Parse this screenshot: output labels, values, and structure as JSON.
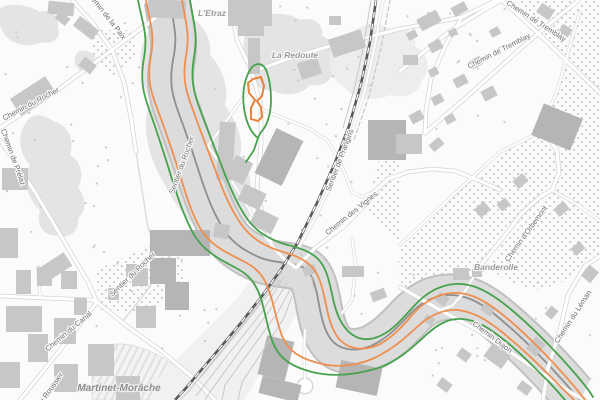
{
  "map": {
    "kind": "grayscale-street-map",
    "streets": [
      {
        "id": "chemin-de-la-paix",
        "text": "Chemin de la Paix"
      },
      {
        "id": "chemin-du-rocher",
        "text": "Chemin du Rocher"
      },
      {
        "id": "chemin-de-prelaz",
        "text": "Chemin de Prélaz"
      },
      {
        "id": "chemin-de-tremblay-1",
        "text": "Chemin de Tremblay"
      },
      {
        "id": "chemin-de-tremblay-2",
        "text": "Chemin de Tremblay"
      },
      {
        "id": "sentier-de-prangins",
        "text": "Sentier de Prangins"
      },
      {
        "id": "sentier-du-rocher-upper",
        "text": "Sentier du Rocher"
      },
      {
        "id": "chemin-des-vignes",
        "text": "Chemin des Vignes"
      },
      {
        "id": "chemin-d-orbemont",
        "text": "Chemin d'Orbemont"
      },
      {
        "id": "chemin-du-leman",
        "text": "Chemin du Léman"
      },
      {
        "id": "chemin-dujon",
        "text": "Chemin Dujon"
      },
      {
        "id": "chemin-du-canal",
        "text": "Chemin du Canal"
      },
      {
        "id": "sentier-du-rocher-lower",
        "text": "Sentier du Rocher"
      },
      {
        "id": "chemin-du-roussier",
        "text": "du Roussier"
      }
    ],
    "localities": [
      {
        "id": "l-etraz",
        "text": "L'Etraz"
      },
      {
        "id": "la-redoute",
        "text": "La Redoute"
      },
      {
        "id": "banderolle",
        "text": "Banderolle"
      },
      {
        "id": "martinet-morache",
        "text": "Martinet-Morâche"
      }
    ],
    "colors": {
      "background": "#fbfbfb",
      "trail_orange": "#ee8f4f",
      "trail_green": "#46a24c",
      "highlight_orange": "#e8823a",
      "railway": "#5a5a5a",
      "stream": "#8f8f8f",
      "ravine_fill": "#dcdcdc",
      "ravine_edge": "#c0c0c0",
      "building": "#c7c7c7",
      "building_dark": "#b5b5b5",
      "road_casing": "#d4d4d4",
      "vegetation": "#e4e4e4",
      "street_label": "#6e6e6e",
      "locality_label": "#9b9b9b"
    },
    "features": {
      "ravine_corridor": "wooded stream ravine crossing map from top-left to bottom-right",
      "railway": "railway line with station yard tracks at bottom-left",
      "trails": "orange and green marked hiking routes along both sides of the ravine",
      "vineyard_dots": "dotted vineyard/orchard texture on right side",
      "construction_hatch": "hatched area near Martinet-Morâche",
      "highlighted_feature": "small orange-outlined parcel with green path loop near top-center"
    }
  }
}
